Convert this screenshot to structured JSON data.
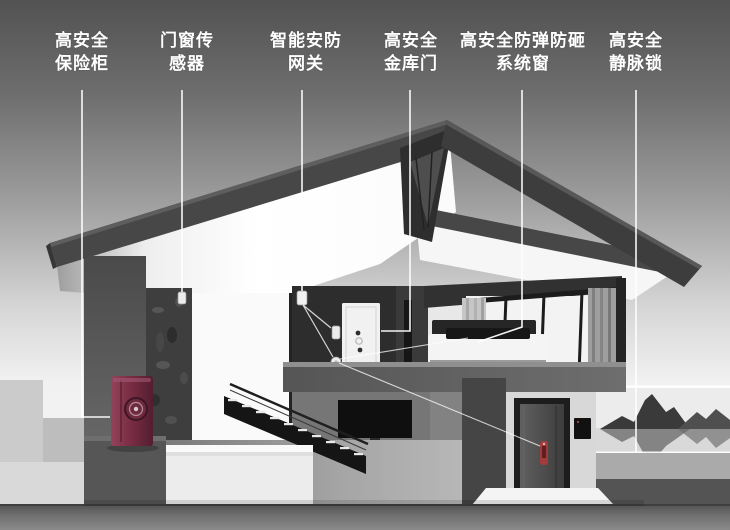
{
  "figure": {
    "type": "annotated-home-security-cutaway",
    "labels": [
      {
        "id": "safe-box",
        "line1": "高安全",
        "line2": "保险柜"
      },
      {
        "id": "door-window-sensor",
        "line1": "门窗传",
        "line2": "感器"
      },
      {
        "id": "security-gateway",
        "line1": "智能安防",
        "line2": "网关"
      },
      {
        "id": "vault-door",
        "line1": "高安全",
        "line2": "金库门"
      },
      {
        "id": "bulletproof-window",
        "line1": "高安全防弹防砸",
        "line2": "系统窗"
      },
      {
        "id": "vein-lock",
        "line1": "高安全",
        "line2": "静脉锁"
      }
    ],
    "colors": {
      "label_text": "#ffffff",
      "leader_line": "#ffffff",
      "safe_body": "#7b2d44",
      "lock_accent": "#a23b3b",
      "sky_top": "#525252",
      "sky_bottom": "#e8e8e8"
    }
  }
}
